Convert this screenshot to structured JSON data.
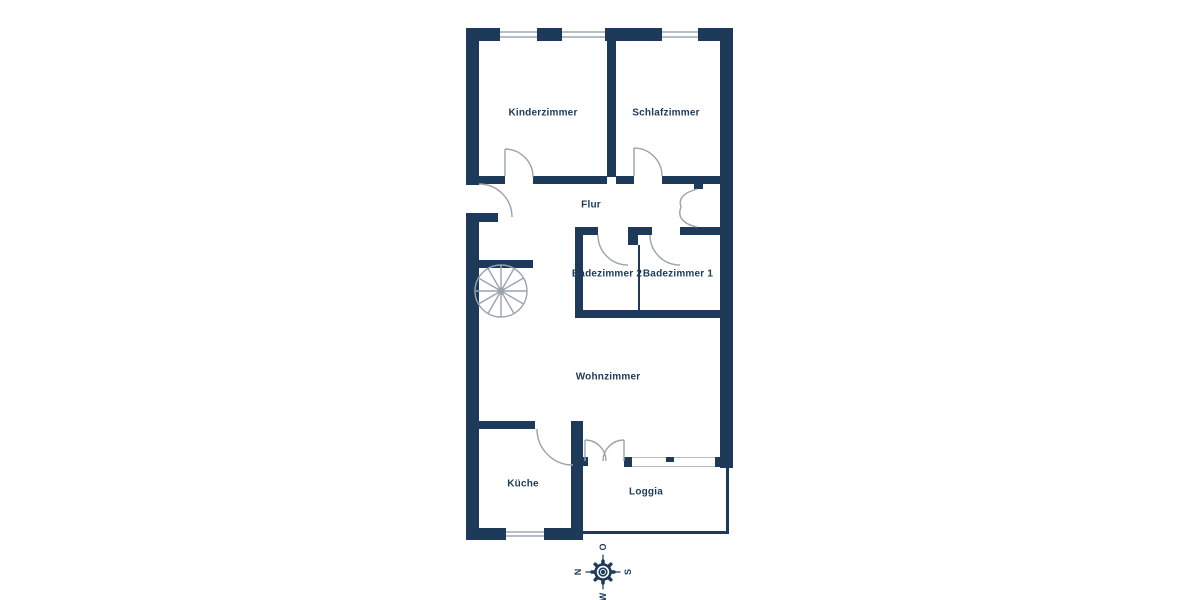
{
  "plan": {
    "rooms": [
      {
        "name": "Kinderzimmer"
      },
      {
        "name": "Schlafzimmer"
      },
      {
        "name": "Flur"
      },
      {
        "name": "Badezimmer 2"
      },
      {
        "name": "Badezimmer 1"
      },
      {
        "name": "Wohnzimmer"
      },
      {
        "name": "Küche"
      },
      {
        "name": "Loggia"
      }
    ],
    "compass": {
      "north": "N",
      "east": "O",
      "south": "S",
      "west": "W"
    },
    "colors": {
      "wall": "#1e3a5b",
      "line": "#9aa3ad",
      "glass": "#b6bdc8",
      "text": "#1d3a5a",
      "background": "#ffffff"
    }
  }
}
